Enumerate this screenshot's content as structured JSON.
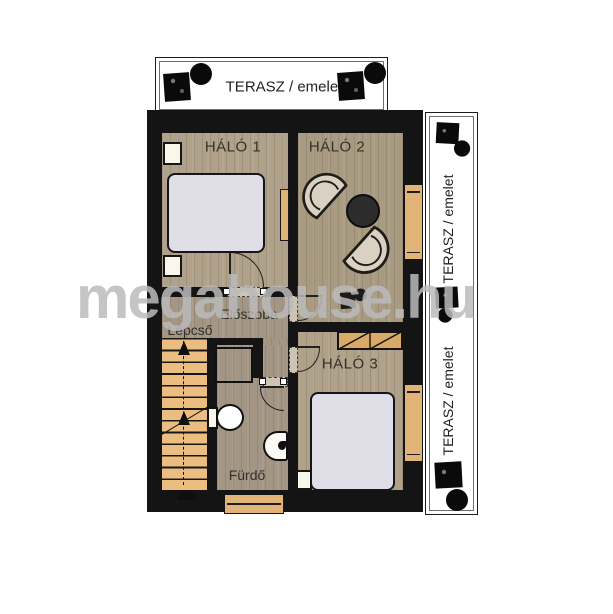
{
  "watermark": "megahouse.hu",
  "terrace_top": {
    "label": "TERASZ / emelet"
  },
  "terrace_right": {
    "label_upper": "TERASZ / emelet",
    "label_lower": "TERASZ / emelet"
  },
  "rooms": {
    "halo1": {
      "label": "HÁLÓ 1",
      "furniture": [
        "double-bed",
        "nightstand",
        "nightstand",
        "radiator",
        "door"
      ]
    },
    "halo2": {
      "label": "HÁLÓ 2",
      "furniture": [
        "armchair",
        "armchair",
        "round-table",
        "plant",
        "terrace-door",
        "door"
      ]
    },
    "halo3": {
      "label": "HÁLÓ 3",
      "furniture": [
        "double-bed",
        "wardrobe",
        "nightstand",
        "terrace-door",
        "door"
      ]
    },
    "eloszoba": {
      "label": "Előszoba"
    },
    "lepcso": {
      "label": "Lépcső",
      "furniture": [
        "staircase-up"
      ]
    },
    "furdo": {
      "label": "Fürdő",
      "furniture": [
        "shower",
        "toilet",
        "sink",
        "window",
        "door"
      ]
    }
  },
  "colors": {
    "wall": "#141414",
    "floor_wood": "#b0a18a",
    "floor_gray": "#a49685",
    "stairs": "#ecbd80",
    "joinery_tan": "#e2b377",
    "bed": "#e0dfe8",
    "watermark_gray": "#bbbbbb"
  }
}
